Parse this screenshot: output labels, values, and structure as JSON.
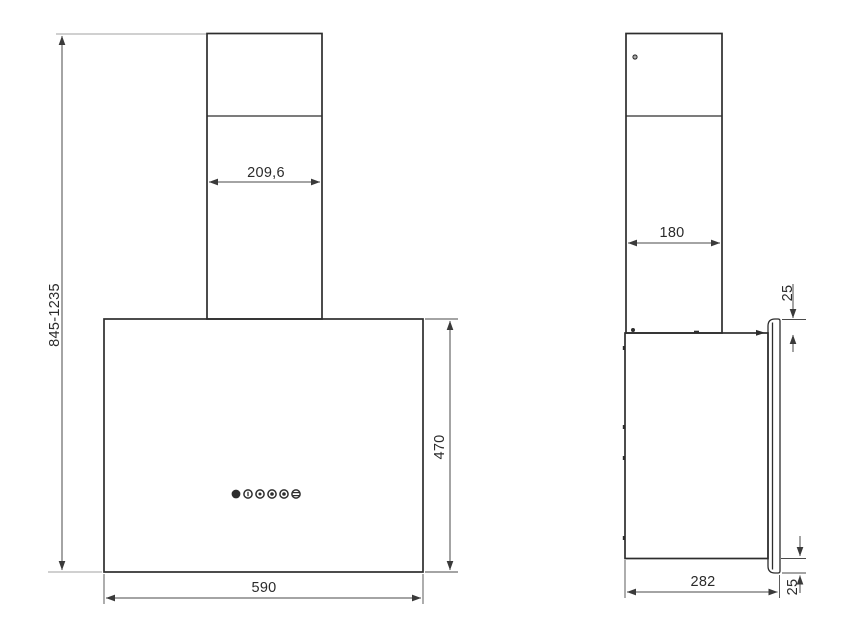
{
  "drawing": {
    "type": "technical-dimension-drawing",
    "subject": "wall-mounted cooker hood, front and side elevation",
    "units": "mm",
    "colors": {
      "background": "#ffffff",
      "outline": "#2d2d2d",
      "dimension": "#4a4a4a",
      "extension_light": "#b5b5b5",
      "text": "#2b2b2b"
    }
  },
  "front_view": {
    "total_height": "845-1235",
    "chimney_width": "209,6",
    "body_width": "590",
    "body_height": "470",
    "control_buttons": [
      "power",
      "speed-1",
      "speed-2",
      "speed-3",
      "timer",
      "light"
    ]
  },
  "side_view": {
    "chimney_depth": "180",
    "panel_top_offset": "25",
    "panel_bottom_offset": "25",
    "body_depth": "282"
  }
}
